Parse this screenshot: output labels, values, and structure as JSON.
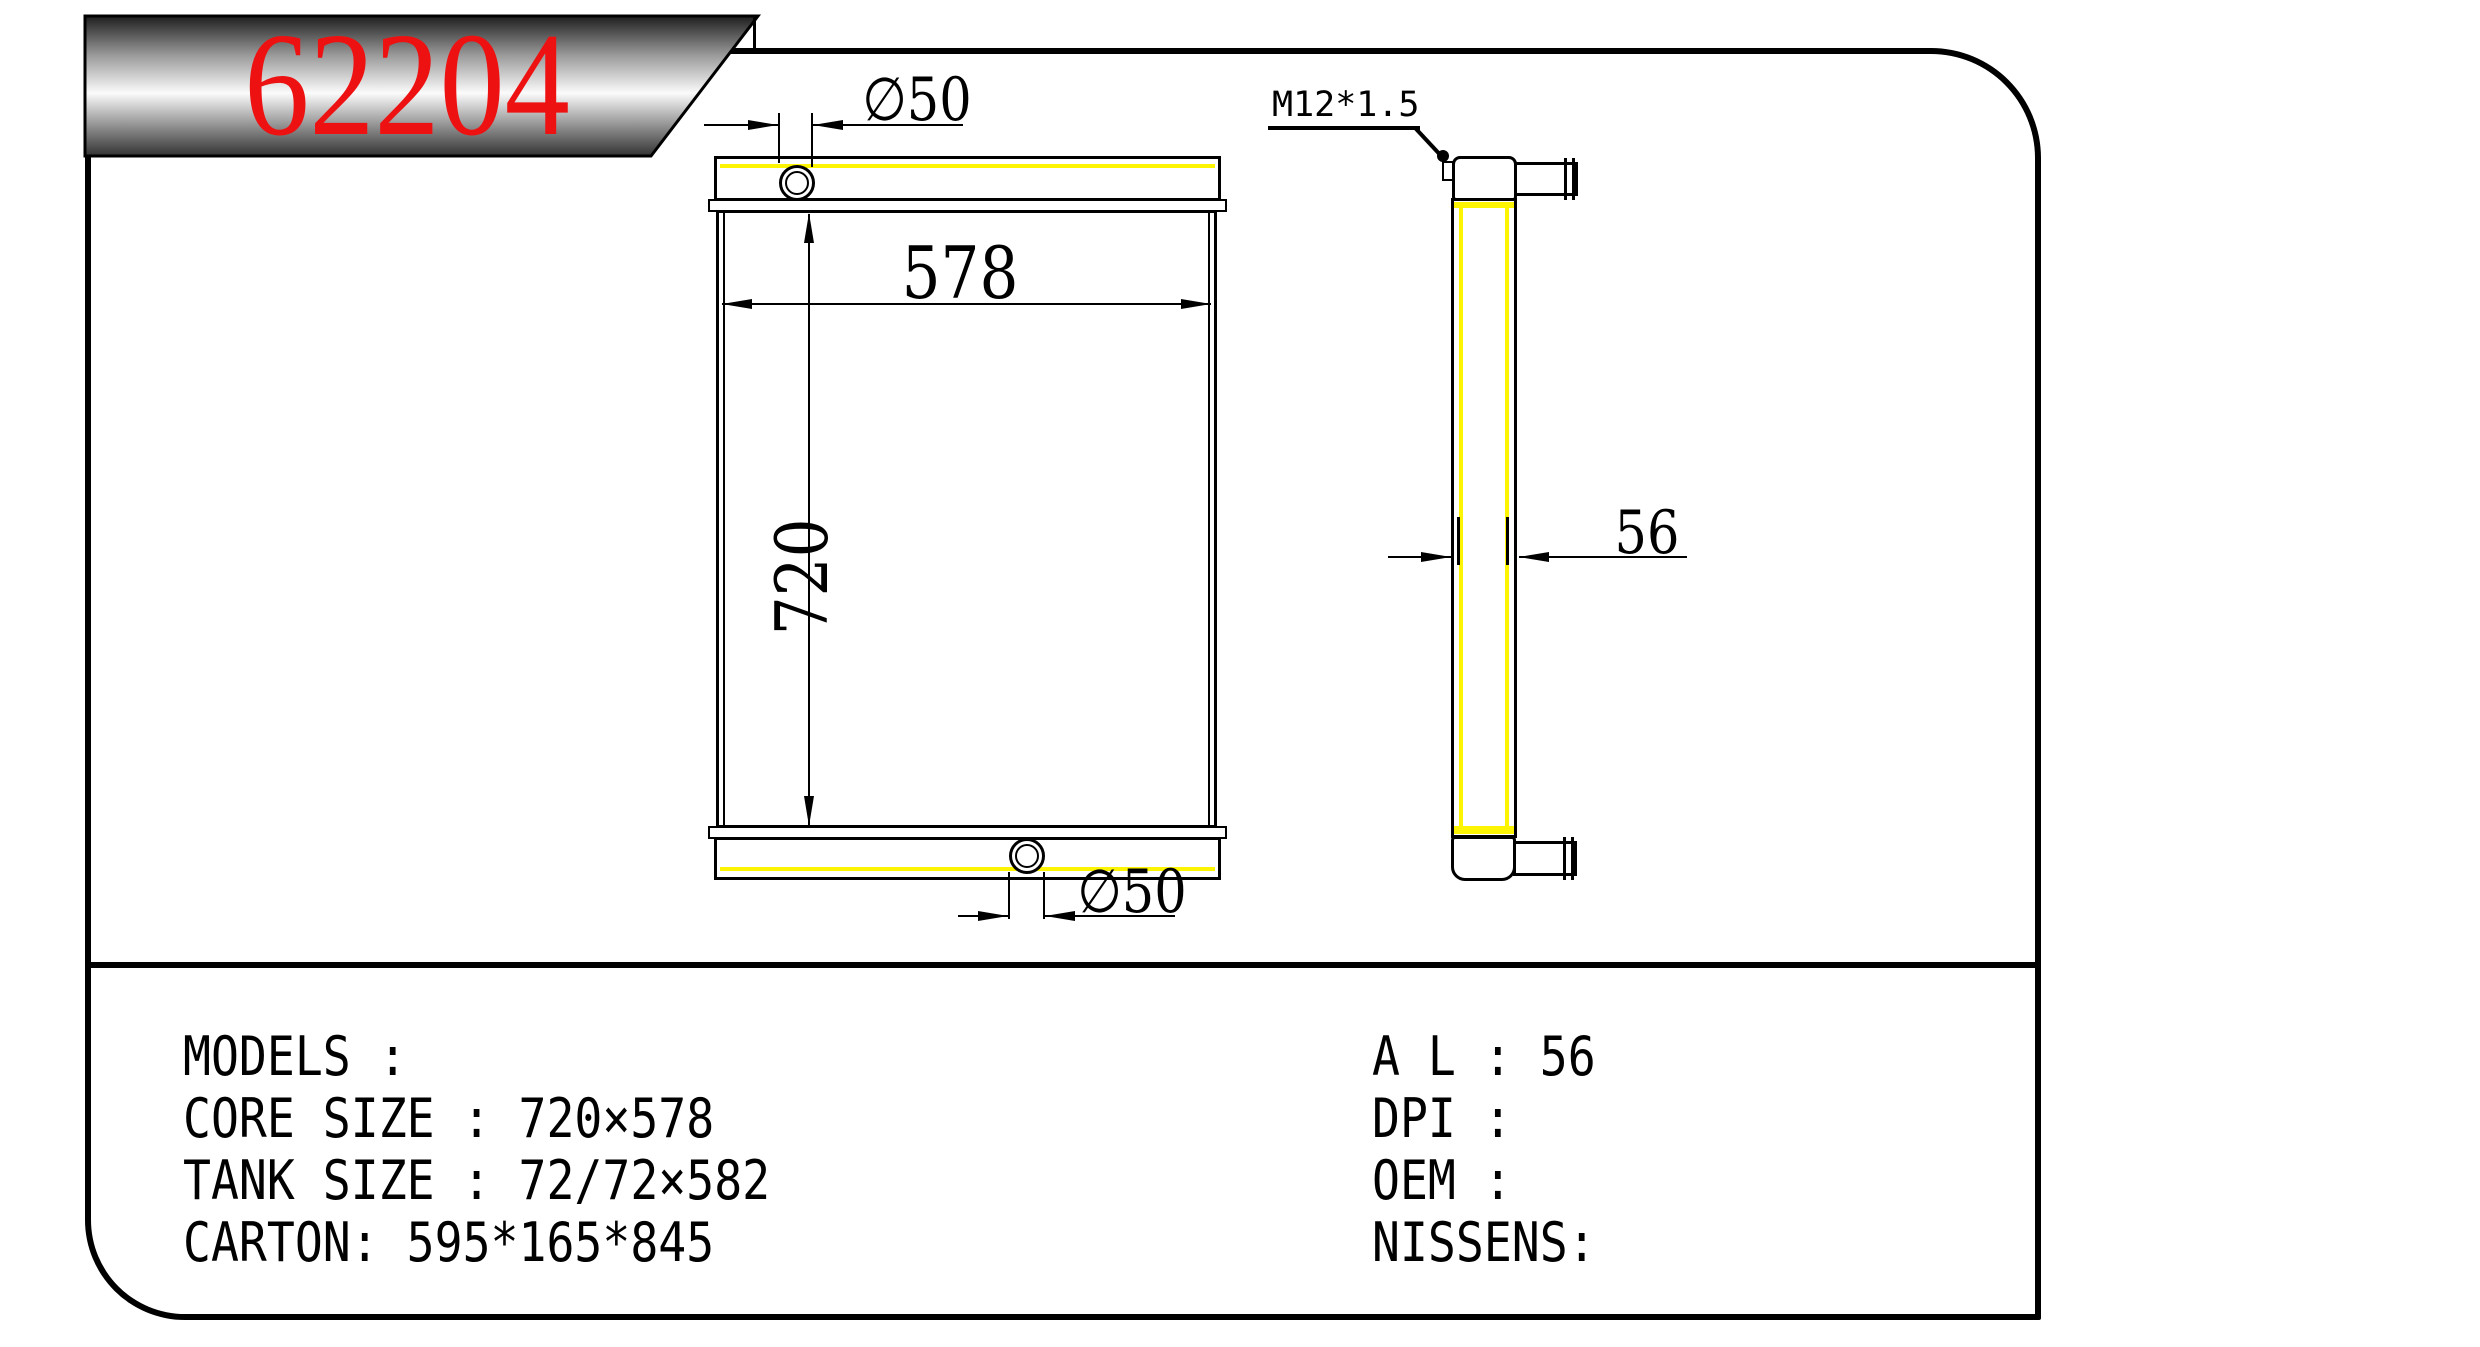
{
  "banner": {
    "part_number": "62204"
  },
  "front_view": {
    "width_dim": "578",
    "height_dim": "720",
    "top_port_dim": "∅50",
    "bottom_port_dim": "∅50"
  },
  "side_view": {
    "thickness_dim": "56",
    "thread_label": "M12*1.5"
  },
  "specs": {
    "models": "MODELS :",
    "core_size": "CORE SIZE : 720×578",
    "tank_size": "TANK SIZE : 72/72×582",
    "carton": "CARTON: 595*165*845",
    "al": "A L : 56",
    "dpi": "DPI :",
    "oem": "OEM :",
    "nissens": "NISSENS:"
  },
  "colors": {
    "accent_red": "#ee1111",
    "highlight_yellow": "#fcf400",
    "line_black": "#000000"
  }
}
